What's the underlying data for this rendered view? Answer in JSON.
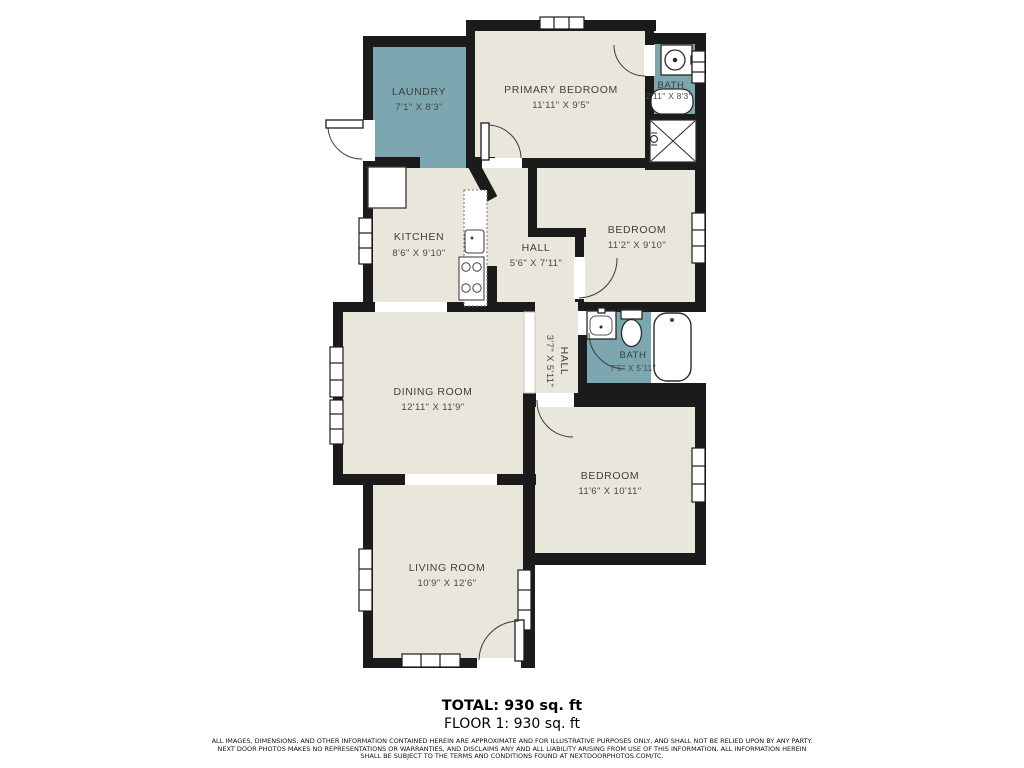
{
  "palette": {
    "wall": "#1b1b1b",
    "floor": "#e9e7dc",
    "wet_room": "#7ca7b0",
    "label_text": "#3e3f3f",
    "background": "#ffffff"
  },
  "rooms": [
    {
      "id": "laundry",
      "name": "LAUNDRY",
      "dims": "7'1\" X 8'3\""
    },
    {
      "id": "primary-bedroom",
      "name": "PRIMARY BEDROOM",
      "dims": "11'11\" X 9'5\""
    },
    {
      "id": "bath-upper",
      "name": "BATH",
      "dims": "2'11\" X 8'3\""
    },
    {
      "id": "kitchen",
      "name": "KITCHEN",
      "dims": "8'6\" X 9'10\""
    },
    {
      "id": "hall-upper",
      "name": "HALL",
      "dims": "5'6\" X 7'11\""
    },
    {
      "id": "bedroom-ne",
      "name": "BEDROOM",
      "dims": "11'2\" X 9'10\""
    },
    {
      "id": "dining-room",
      "name": "DINING ROOM",
      "dims": "12'11\" X 11'9\""
    },
    {
      "id": "hall-mid",
      "name": "HALL",
      "dims": "3'7\" X 5'11\""
    },
    {
      "id": "bath-mid",
      "name": "BATH",
      "dims": "7'5\" X 5'11\""
    },
    {
      "id": "bedroom-se",
      "name": "BEDROOM",
      "dims": "11'6\" X 10'11\""
    },
    {
      "id": "living-room",
      "name": "LIVING ROOM",
      "dims": "10'9\" X 12'6\""
    }
  ],
  "fixtures": [
    "bathroom-sink",
    "bathtub",
    "shower",
    "toilet",
    "kitchen-counter",
    "kitchen-sink",
    "stove",
    "refrigerator"
  ],
  "footer": {
    "total": "TOTAL: 930 sq. ft",
    "floor": "FLOOR 1: 930 sq. ft",
    "disclaimer": [
      "ALL IMAGES, DIMENSIONS, AND OTHER INFORMATION CONTAINED HEREIN ARE APPROXIMATE AND FOR ILLUSTRATIVE PURPOSES ONLY, AND SHALL NOT BE RELIED UPON BY ANY PARTY.",
      "NEXT DOOR PHOTOS MAKES NO REPRESENTATIONS OR WARRANTIES, AND DISCLAIMS ANY AND ALL LIABILITY ARISING FROM USE OF THIS INFORMATION. ALL INFORMATION HEREIN",
      "SHALL BE SUBJECT TO THE TERMS AND CONDITIONS FOUND AT NEXTDOORPHOTOS.COM/TC."
    ]
  }
}
